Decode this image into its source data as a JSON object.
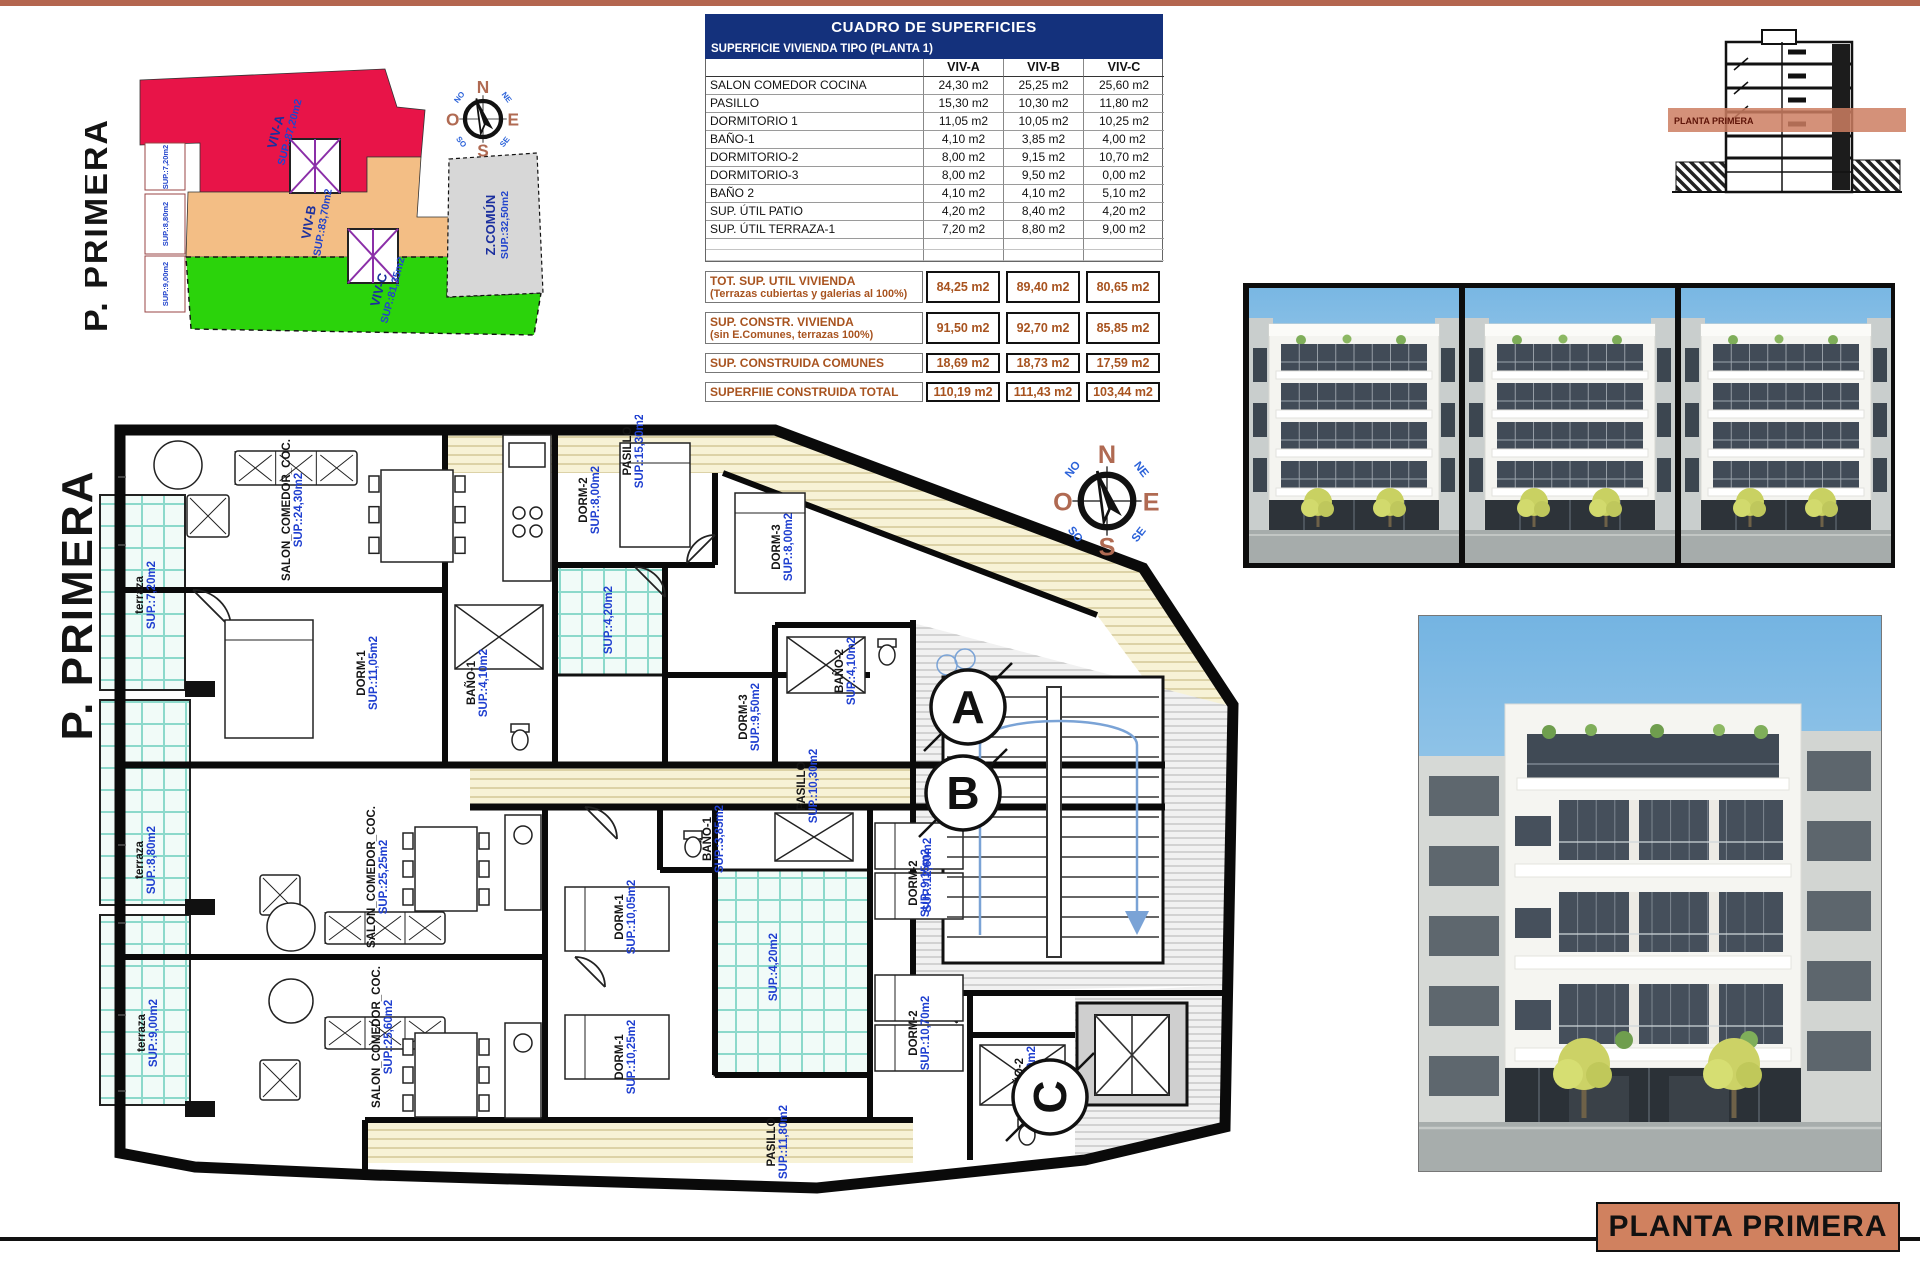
{
  "palette": {
    "top_bar": "#b4664f",
    "table_header_bg": "#14317c",
    "summary_text": "#a8531f",
    "footer_box_bg": "#d0815f",
    "section_band": "#cd7e62",
    "label_blue": "#1f3fd0"
  },
  "key_plan": {
    "title": "P. PRIMERA",
    "zones": [
      {
        "name": "VIV-A",
        "area": "SUP.:87,20m2",
        "color": "#e81448"
      },
      {
        "name": "VIV-B",
        "area": "SUP.:83,70m2",
        "color": "#f3be85"
      },
      {
        "name": "VIV-C",
        "area": "SUP.:81,35m2",
        "color": "#2bd30b"
      },
      {
        "name": "Z.COMÚN",
        "area": "SUP.:32,50m2",
        "color": "#d7d7d7"
      }
    ],
    "terrace_boxes": [
      "SUP.:7,20m2",
      "SUP.:8,80m2",
      "SUP.:9,00m2"
    ]
  },
  "compass": {
    "n": "N",
    "e": "E",
    "s": "S",
    "o": "O",
    "ne": "NE",
    "no": "NO",
    "se": "SE",
    "so": "SO"
  },
  "areas_table": {
    "title": "CUADRO DE SUPERFICIES",
    "subtitle": "SUPERFICIE VIVIENDA TIPO  (PLANTA 1)",
    "columns": [
      "VIV-A",
      "VIV-B",
      "VIV-C"
    ],
    "rows": [
      {
        "label": "SALON COMEDOR COCINA",
        "values": [
          "24,30 m2",
          "25,25 m2",
          "25,60 m2"
        ]
      },
      {
        "label": "PASILLO",
        "values": [
          "15,30 m2",
          "10,30 m2",
          "11,80 m2"
        ]
      },
      {
        "label": "DORMITORIO 1",
        "values": [
          "11,05 m2",
          "10,05 m2",
          "10,25 m2"
        ]
      },
      {
        "label": "BAÑO-1",
        "values": [
          "4,10 m2",
          "3,85 m2",
          "4,00 m2"
        ]
      },
      {
        "label": "DORMITORIO-2",
        "values": [
          "8,00 m2",
          "9,15 m2",
          "10,70 m2"
        ]
      },
      {
        "label": "DORMITORIO-3",
        "values": [
          "8,00 m2",
          "9,50 m2",
          "0,00 m2"
        ]
      },
      {
        "label": "BAÑO 2",
        "values": [
          "4,10 m2",
          "4,10 m2",
          "5,10 m2"
        ]
      },
      {
        "label": "SUP. ÚTIL PATIO",
        "values": [
          "4,20 m2",
          "8,40 m2",
          "4,20 m2"
        ]
      },
      {
        "label": "SUP. ÚTIL TERRAZA-1",
        "values": [
          "7,20 m2",
          "8,80 m2",
          "9,00 m2"
        ]
      }
    ],
    "summary_rows": [
      {
        "label": "TOT. SUP. UTIL VIVIENDA",
        "sublabel": "(Terrazas cubiertas y galerias al 100%)",
        "values": [
          "84,25 m2",
          "89,40 m2",
          "80,65 m2"
        ]
      },
      {
        "label": "SUP. CONSTR. VIVIENDA",
        "sublabel": "(sin E.Comunes, terrazas 100%)",
        "values": [
          "91,50 m2",
          "92,70 m2",
          "85,85 m2"
        ]
      },
      {
        "label": "SUP. CONSTRUIDA COMUNES",
        "sublabel": "",
        "values": [
          "18,69 m2",
          "18,73 m2",
          "17,59 m2"
        ]
      },
      {
        "label": "SUPERFIIE CONSTRUIDA TOTAL",
        "sublabel": "",
        "values": [
          "110,19 m2",
          "111,43 m2",
          "103,44 m2"
        ]
      }
    ]
  },
  "section_drawing": {
    "band_label": "PLANTA PRIMERA"
  },
  "floor_plan": {
    "title": "P. PRIMERA",
    "section_markers": [
      "A",
      "B",
      "C"
    ],
    "rooms": [
      {
        "label": "SALON_COMEDOR_COC.",
        "area": "SUP.:24,30m2",
        "x": 215,
        "y": 95,
        "rot": -90
      },
      {
        "label": "terraza",
        "area": "SUP.:7,20m2",
        "x": 68,
        "y": 180,
        "rot": -90
      },
      {
        "label": "DORM-1",
        "area": "SUP.:11,05m2",
        "x": 290,
        "y": 258,
        "rot": -90
      },
      {
        "label": "BAÑO-1",
        "area": "SUP.:4,10m2",
        "x": 400,
        "y": 268,
        "rot": -90
      },
      {
        "label": "DORM-2",
        "area": "SUP.:8,00m2",
        "x": 512,
        "y": 85,
        "rot": -90
      },
      {
        "label": "DORM-3",
        "area": "SUP.:8,00m2",
        "x": 705,
        "y": 132,
        "rot": -90
      },
      {
        "label": "BAÑO-2",
        "area": "SUP.:4,10m2",
        "x": 768,
        "y": 256,
        "rot": -90
      },
      {
        "label": "PASILLO",
        "area": "SUP.:15,30m2",
        "x": 556,
        "y": 36,
        "rot": -90
      },
      {
        "label": "",
        "area": "SUP.:4,20m2",
        "x": 537,
        "y": 205,
        "rot": -90
      },
      {
        "label": "SALON_COMEDOR_COC.",
        "area": "SUP.:25,25m2",
        "x": 300,
        "y": 462,
        "rot": -90
      },
      {
        "label": "terraza",
        "area": "SUP.:8,80m2",
        "x": 68,
        "y": 445,
        "rot": -90
      },
      {
        "label": "PASILLO",
        "area": "SUP.:10,30m2",
        "x": 730,
        "y": 371,
        "rot": -90
      },
      {
        "label": "DORM-3",
        "area": "SUP.:9,50m2",
        "x": 672,
        "y": 302,
        "rot": -90
      },
      {
        "label": "BAÑO-1",
        "area": "SUP.:3,85m2",
        "x": 636,
        "y": 424,
        "rot": -90
      },
      {
        "label": "DORM-1",
        "area": "SUP.:10,05m2",
        "x": 548,
        "y": 502,
        "rot": -90
      },
      {
        "label": "DORM-2",
        "area": "SUP.:9,15m2",
        "x": 842,
        "y": 468,
        "rot": -90
      },
      {
        "label": "",
        "area": "SUP.:4,20m2",
        "x": 702,
        "y": 552,
        "rot": -90
      },
      {
        "label": "SALON_COMEDOR_COC.",
        "area": "SUP.:25,60m2",
        "x": 305,
        "y": 622,
        "rot": -90
      },
      {
        "label": "terraza",
        "area": "SUP.:9,00m2",
        "x": 70,
        "y": 618,
        "rot": -90
      },
      {
        "label": "DORM-1",
        "area": "SUP.:10,25m2",
        "x": 548,
        "y": 642,
        "rot": -90
      },
      {
        "label": "DORM-2",
        "area": "SUP.:10,70m2",
        "x": 842,
        "y": 618,
        "rot": -90
      },
      {
        "label": "PASILLO",
        "area": "SUP.:11,80m2",
        "x": 700,
        "y": 727,
        "rot": -90
      },
      {
        "label": "BAÑO-2",
        "area": "SUP.:5,10m2",
        "x": 948,
        "y": 665,
        "rot": -90
      },
      {
        "label": "",
        "area": "SUP.:12,60m2",
        "x": 856,
        "y": 460,
        "rot": -90
      }
    ]
  },
  "footer": {
    "label": "PLANTA PRIMERA"
  }
}
